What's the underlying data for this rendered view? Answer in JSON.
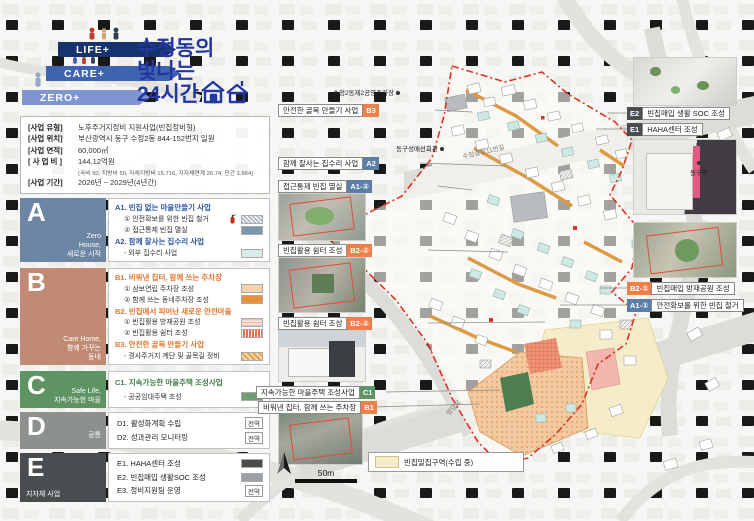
{
  "colors": {
    "title_blue": "#2437a0",
    "arrow_navy": "#16336e",
    "arrow_blue": "#3f63ae",
    "arrow_periwinkle": "#8096d2",
    "section_a": "#6d86a4",
    "section_b": "#c18a73",
    "section_c": "#5e9362",
    "section_d": "#8d918d",
    "section_e": "#4a4d4f",
    "code_blue": "#5b7fa6",
    "code_orange": "#ed7f4a",
    "boundary_red": "#e0301e",
    "vacant_zone_yellow": "#f5edca"
  },
  "logo": {
    "arrow1": "LIFE+",
    "arrow2": "CARE+",
    "arrow3": "ZERO+",
    "title1": "수정동의",
    "title2": "빛나는",
    "title3": "24시간"
  },
  "info": {
    "rows": [
      {
        "label": "[사업 유형]",
        "value": "노후주거지정비 지원사업(빈집정비형)"
      },
      {
        "label": "[사업 위치]",
        "value": "부산광역시 동구 수정2동 844-152번지 일원"
      },
      {
        "label": "[사업 면적]",
        "value": "60,000㎡"
      },
      {
        "label": "[ 사 업 비 ]",
        "value": "144.12억원"
      },
      {
        "label": "[사업 기간]",
        "value": "2026년 ~ 2029년(4년간)"
      }
    ],
    "cost_note": "(국비 50, 지방비 50, 자체지방비 15.716, 지자체연계 26.74, 민간 1.664)"
  },
  "sections": [
    {
      "letter": "A",
      "subtitle": "Zero\nHouse,\n새로운 시작",
      "groups": [
        {
          "heading": "A1. 빈집 없는 마을만들기 사업",
          "items": [
            {
              "text": "① 안전확보를 위한 빈집 철거"
            },
            {
              "text": "② 접근통제 빈집 멸실"
            }
          ]
        },
        {
          "heading": "A2. 함께 잘사는 집수리 사업",
          "items": [
            {
              "text": "- 외부 집수리 사업"
            }
          ]
        }
      ]
    },
    {
      "letter": "B",
      "subtitle": "Care Home,\n함께 가꾸는\n동네",
      "groups": [
        {
          "heading": "B1. 비워낸 집터, 함께 쓰는 주차장",
          "items": [
            {
              "text": "① 삼보연립 주차장 조성"
            },
            {
              "text": "② 함께 쓰는 동네주차장 조성"
            }
          ]
        },
        {
          "heading": "B2. 빈집에서 피어난 새로운 안전마을",
          "items": [
            {
              "text": "① 빈집활용 방재공원 조성"
            },
            {
              "text": "② 빈집활용 쉼터 조성"
            }
          ]
        },
        {
          "heading": "B3. 안전한 골목 만들기 사업",
          "items": [
            {
              "text": "- 경사주거지 계단 및 골목길 정비"
            }
          ]
        }
      ]
    },
    {
      "letter": "C",
      "subtitle": "Safe Life,\n지속가능한 마을",
      "groups": [
        {
          "heading": "C1. 지속가능한 마을주택 조성사업",
          "items": [
            {
              "text": "- 공공임대주택 조성"
            }
          ]
        }
      ]
    },
    {
      "letter": "D",
      "subtitle": "공통",
      "groups": [
        {
          "heading": "",
          "items": [
            {
              "text": "D1. 활성화계획 수립",
              "badge": "전역"
            },
            {
              "text": "D2. 성과관리 모니터링",
              "badge": "전역"
            }
          ]
        }
      ]
    },
    {
      "letter": "E",
      "subtitle": "지자체 사업",
      "groups": [
        {
          "heading": "",
          "items": [
            {
              "text": "E1. HAHA센터 조성"
            },
            {
              "text": "E2. 빈집매입 생활SOC 조성"
            },
            {
              "text": "E3. 정비지원팀 운영",
              "badge": "전역"
            }
          ]
        }
      ]
    }
  ],
  "callouts_left": [
    {
      "text": "안전한 골목 만들기 사업",
      "code": "B3"
    },
    {
      "text": "함께 잘사는 집수리 사업",
      "code": "A2"
    },
    {
      "text": "접근통제 빈집 멸실",
      "code": "A1-②"
    },
    {
      "text": "빈집활용 쉼터 조성",
      "code": "B2-②"
    },
    {
      "text": "빈집활용 쉼터 조성",
      "code": "B2-②"
    },
    {
      "text": "지속가능한 마을주택 조성사업",
      "code": "C1"
    },
    {
      "text": "비워낸 집터, 함께 쓰는 주차장",
      "code": "B1"
    }
  ],
  "callouts_right": [
    {
      "code": "E2",
      "text": "빈집매입 생활 SOC 조성"
    },
    {
      "code": "E1",
      "text": "HAHA센터 조성"
    },
    {
      "code": "B2-①",
      "text": "빈집매입 방재공원 조성"
    },
    {
      "code": "A1-①",
      "text": "안전확보를 위한 빈집 철거"
    }
  ],
  "map": {
    "markers": [
      {
        "name": "수정2동제2공영주차장"
      },
      {
        "name": "동구성매선회관"
      },
      {
        "name": "동구청"
      }
    ],
    "roads": [
      {
        "name": "수정중로11번길"
      },
      {
        "name": "망양로"
      }
    ],
    "scale_label": "50m",
    "legend_label": "빈집밀집구역(수립 중)"
  }
}
